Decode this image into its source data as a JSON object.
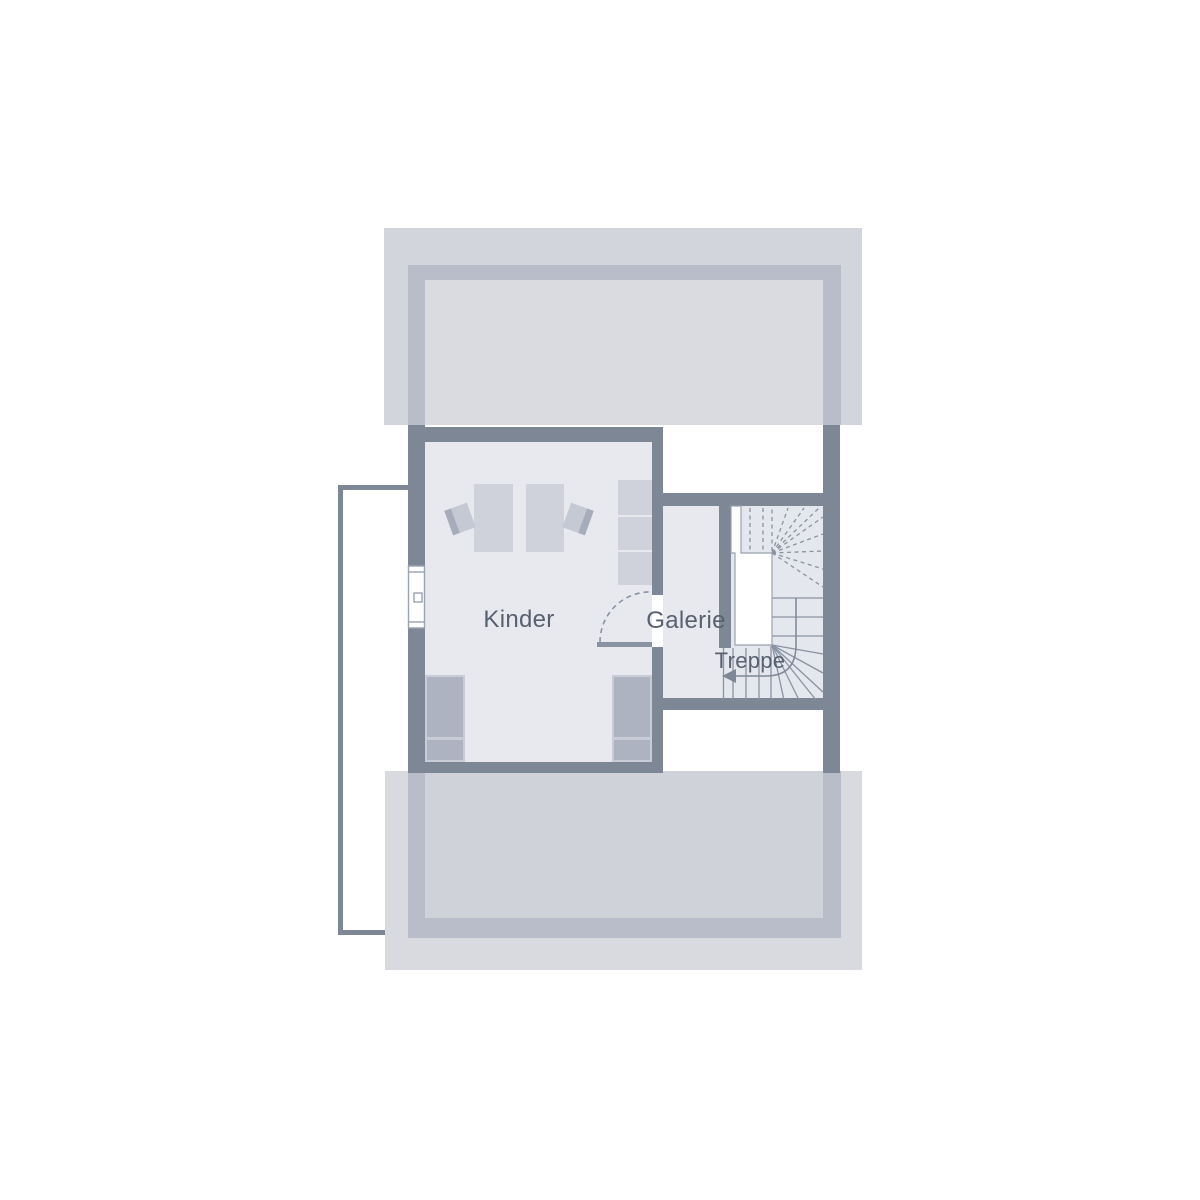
{
  "plan": {
    "kind": "floor-plan",
    "rooms": [
      {
        "label": "Kinder"
      },
      {
        "label": "Galerie"
      },
      {
        "label": "Treppe"
      }
    ]
  },
  "icons": {
    "stair_direction_arrow": "left-arrow",
    "door_swing": "quarter-arc-dashed",
    "window": "window-symbol"
  },
  "colors": {
    "background": "#ffffff",
    "wall": "#7e8795",
    "wall_under_roof": "#b9bdc9",
    "roof_band_top": "#d3d5dd",
    "roof_band_top_inner": "#d9dbe1",
    "roof_band_bottom": "#d8dae0",
    "roof_band_bottom_inner": "#d0d2da",
    "floor": "#e7e9ef",
    "furniture": "#cfd2db",
    "bed": "#aeb3c1",
    "stair_line": "#8a93a2",
    "label_text": "#596170"
  }
}
